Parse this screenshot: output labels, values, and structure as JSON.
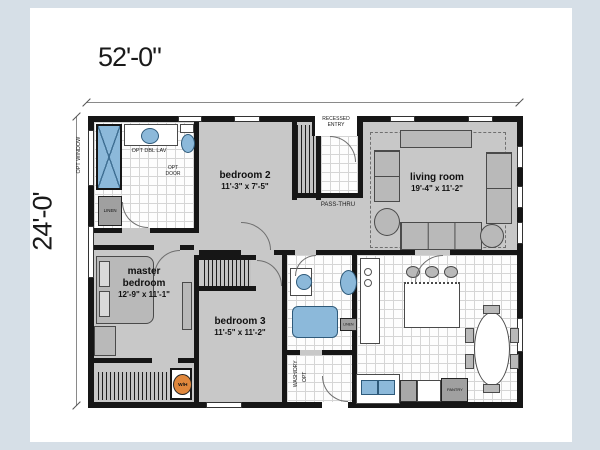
{
  "dimensions": {
    "width_label": "52'-0\"",
    "height_label": "24'-0'"
  },
  "labels": {
    "opt_window": "OPT WINDOW",
    "recessed_entry_line1": "RECESSED",
    "recessed_entry_line2": "ENTRY",
    "pass_thru": "PASS-THRU",
    "opt_dbl_lav": "OPT DBL LAV",
    "opt_door_line1": "OPT",
    "opt_door_line2": "DOOR",
    "linen1": "LINEN",
    "linen2": "LINEN",
    "wash_dry": "WASH/DRY",
    "wash_dry_opt": "OPT",
    "pantry": "PANTRY",
    "water_heater": "W/H"
  },
  "rooms": {
    "bedroom2": {
      "name": "bedroom 2",
      "size": "11'-3\" x 7'-5\""
    },
    "living_room": {
      "name": "living room",
      "size": "19'-4\" x 11'-2\""
    },
    "master_bedroom": {
      "name_line1": "master",
      "name_line2": "bedroom",
      "size": "12'-9\" x 11'-1\""
    },
    "bedroom3": {
      "name": "bedroom 3",
      "size": "11'-5\" x 11'-2\""
    }
  },
  "colors": {
    "page_margin": "#d6dfe7",
    "paper": "#ffffff",
    "wall": "#161616",
    "carpet": "#c8c8c8",
    "fixture_blue": "#8cb9da",
    "water_heater_orange": "#e0873c"
  }
}
